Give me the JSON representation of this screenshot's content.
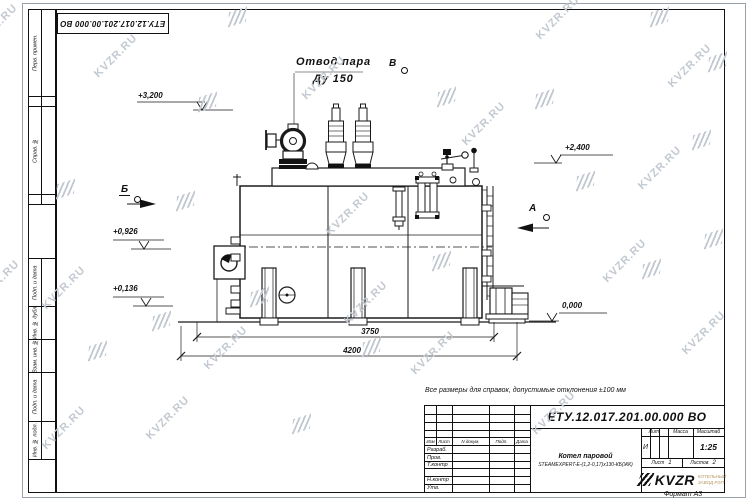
{
  "watermark": {
    "text": "KVZR.RU"
  },
  "corner_stamp": {
    "doc_number": "ЕТУ.12.017.201.00.000  ВО"
  },
  "margin": {
    "cells": [
      {
        "label": "Перв. примен."
      },
      {
        "label": "Справ. №"
      },
      {
        "label": "Подп. и дата"
      },
      {
        "label": "Инв. № дубл."
      },
      {
        "label": "Взам. инв. №"
      },
      {
        "label": "Подп. и дата"
      },
      {
        "label": "Инв. № подл."
      }
    ]
  },
  "annotations": {
    "steam_outlet": {
      "line1": "Отвод пара",
      "line2": "Ду 150"
    },
    "views": [
      {
        "label": "Б"
      },
      {
        "label": "В"
      },
      {
        "label": "А"
      }
    ],
    "elevations": [
      {
        "value": "+3,200"
      },
      {
        "value": "+2,400"
      },
      {
        "value": "+0,926"
      },
      {
        "value": "+0,136"
      },
      {
        "value": "0,000"
      }
    ],
    "dimensions": [
      {
        "value": "3750"
      },
      {
        "value": "4200"
      }
    ]
  },
  "note": "Все размеры для справок, допустимые отклонения  ±100 мм",
  "title_block": {
    "doc_number": "ЕТУ.12.017.201.00.000  ВО",
    "header_row": {
      "izm": "Изм",
      "list": "Лист",
      "ndoc": "N докум.",
      "podp": "Подп.",
      "data": "Дата"
    },
    "rows": [
      {
        "label": "Разраб."
      },
      {
        "label": "Пров."
      },
      {
        "label": "Т.контр"
      },
      {
        "label": "Н.контр"
      },
      {
        "label": "Утв."
      }
    ],
    "product_name_line1": "Котел паровой",
    "product_name_line2": "STEAMEXPERT-Е-(1,2-0,17)х130-КБ(ЖК)",
    "lit_header": "Лит.",
    "lit_value": "И",
    "mass_header": "Масса",
    "scale_header": "Масштаб",
    "scale_value": "1:25",
    "sheet_label": "Лист",
    "sheet_value": "1",
    "sheets_label": "Листов",
    "sheets_value": "2",
    "company": {
      "logo_text": "KVZR",
      "tagline_line1": "КОТЕЛЬНЫЙ",
      "tagline_line2": "ЗАВОД РЭП"
    }
  },
  "format_label": "Формат А3"
}
